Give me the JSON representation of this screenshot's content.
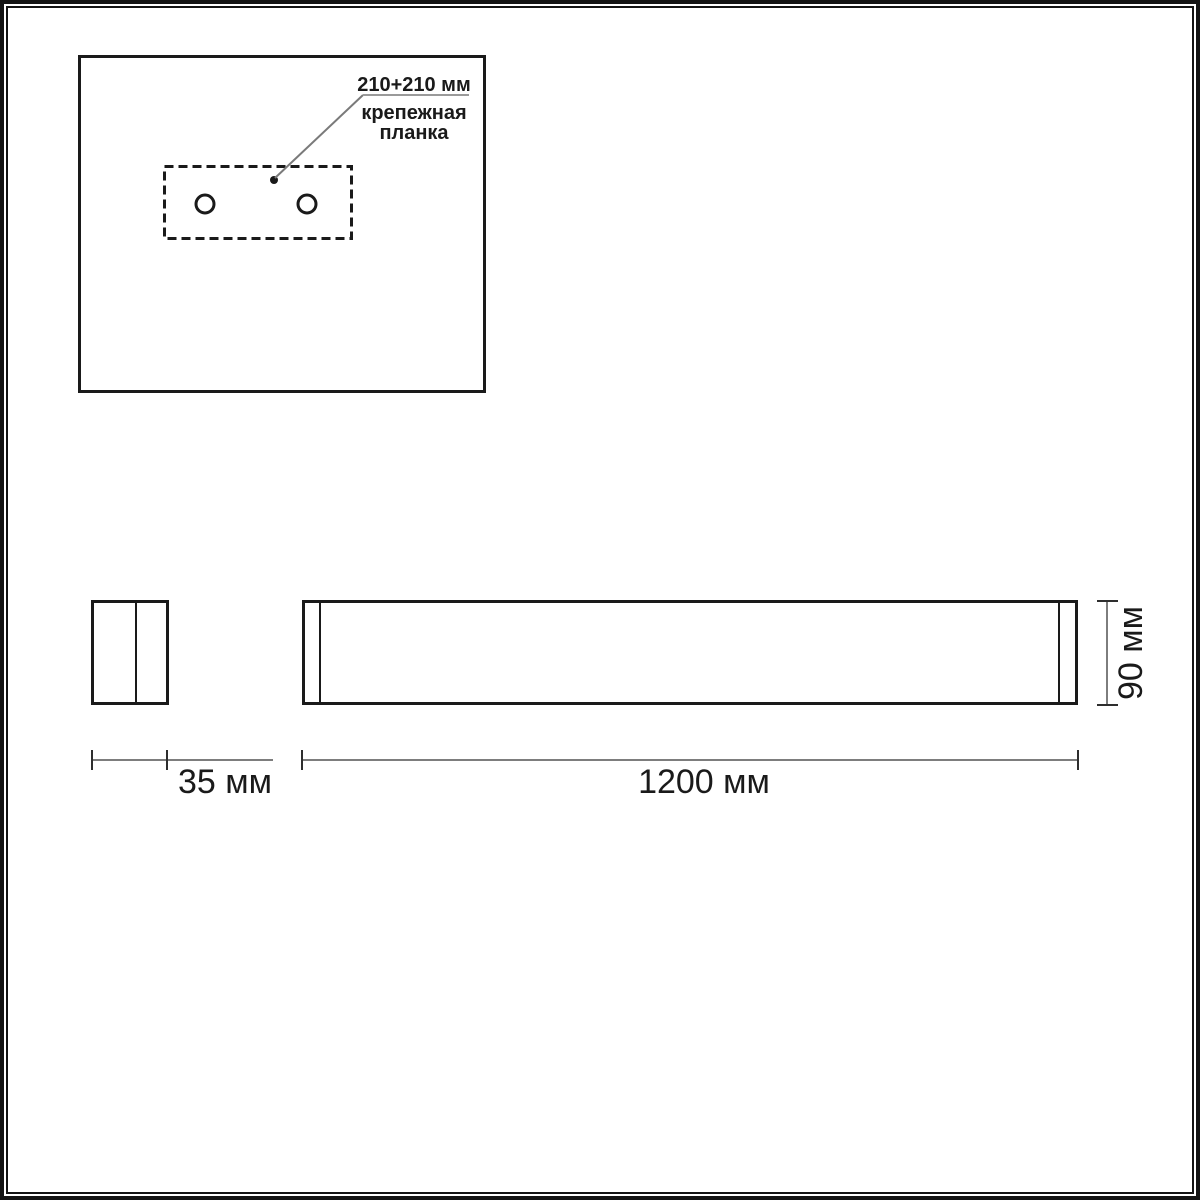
{
  "annotation": {
    "dimension": "210+210 мм",
    "label_line1": "крепежная",
    "label_line2": "планка"
  },
  "dimensions": {
    "depth_label": "35 мм",
    "width_label": "1200 мм",
    "height_label": "90 мм"
  },
  "colors": {
    "drawing_line": "#1a1a1a",
    "dimension_line": "#7d7d7d",
    "dimension_tick": "#2e2e2e",
    "leader_line": "#7a7a7a",
    "leader_underline": "#9a9a9a",
    "background": "#ffffff"
  }
}
